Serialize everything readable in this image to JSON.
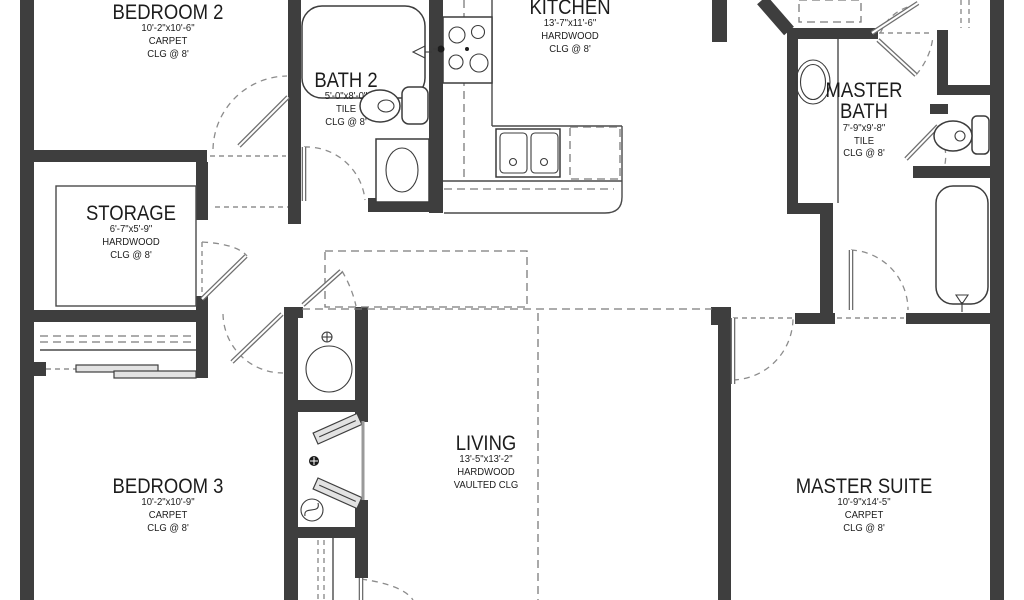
{
  "plan": {
    "title": "house-floor-plan",
    "colors": {
      "wall": "#3e3e3e",
      "line": "#4a4a4a",
      "dashed": "#7b7b7b",
      "background": "#ffffff",
      "text": "#1c1c1c",
      "leaf": "#6f6f6f"
    },
    "rooms": [
      {
        "name": "BEDROOM 2",
        "dims": "10'-2\"x10'-6\"",
        "floor": "CARPET",
        "ceiling": "CLG @ 8'"
      },
      {
        "name": "BATH 2",
        "dims": "5'-0\"x8'-0\"",
        "floor": "TILE",
        "ceiling": "CLG @ 8'"
      },
      {
        "name": "KITCHEN",
        "dims": "13'-7\"x11'-6\"",
        "floor": "HARDWOOD",
        "ceiling": "CLG @ 8'"
      },
      {
        "name": "MASTER BATH",
        "dims": "7'-9\"x9'-8\"",
        "floor": "TILE",
        "ceiling": "CLG @ 8'"
      },
      {
        "name": "STORAGE",
        "dims": "6'-7\"x5'-9\"",
        "floor": "HARDWOOD",
        "ceiling": "CLG @ 8'"
      },
      {
        "name": "BEDROOM 3",
        "dims": "10'-2\"x10'-9\"",
        "floor": "CARPET",
        "ceiling": "CLG @ 8'"
      },
      {
        "name": "LIVING",
        "dims": "13'-5\"x13'-2\"",
        "floor": "HARDWOOD",
        "ceiling": "VAULTED CLG"
      },
      {
        "name": "MASTER SUITE",
        "dims": "10'-9\"x14'-5\"",
        "floor": "CARPET",
        "ceiling": "CLG @ 8'"
      }
    ],
    "fixtures": [
      "bathtub",
      "toilet",
      "vanity-sink",
      "range-stove",
      "double-kitchen-sink",
      "dishwasher",
      "water-heater",
      "bifold-closet-doors",
      "sliding-closet-doors",
      "shower",
      "door-swing"
    ]
  }
}
